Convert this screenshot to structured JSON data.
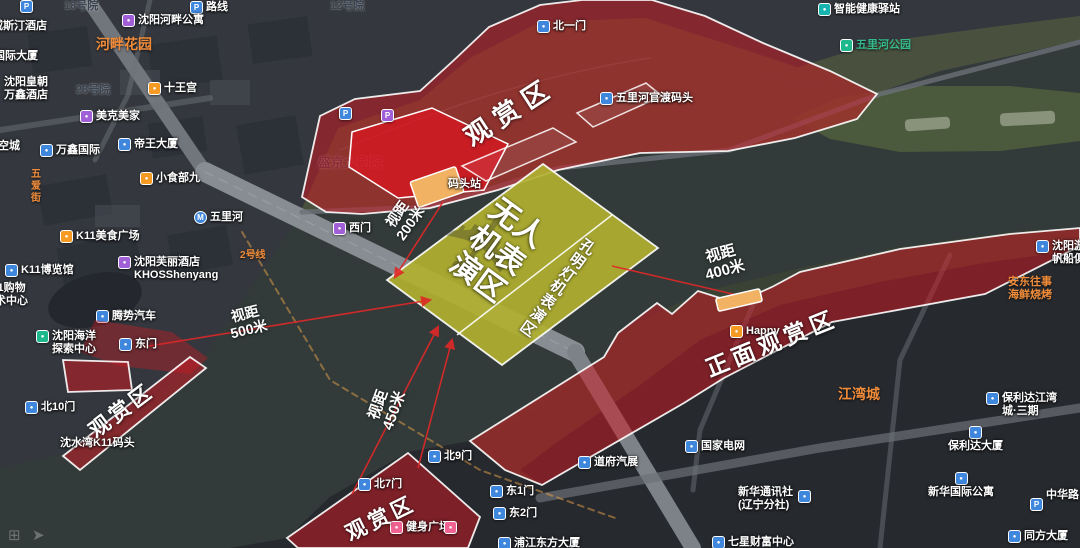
{
  "colors": {
    "viewing_zone_red": "#d01923",
    "bright_zone_red": "#f00f1e",
    "performance_zone_yellow": "#b0b030",
    "dock_orange": "#f2b263",
    "sight_line_red": "#e02828",
    "poi_blue": "#3f87dd",
    "poi_purple": "#a05fd6",
    "poi_orange": "#f59a23",
    "poi_green": "#1db98c",
    "poi_teal": "#17b3ae",
    "poi_pink": "#f06292",
    "area_label_orange": "#f07f32"
  },
  "watermark": {
    "icons": [
      "⊞",
      "➤"
    ]
  },
  "map": {
    "pois": [
      {
        "icon": "parking",
        "t": "",
        "x": 20,
        "y": 0
      },
      {
        "t": "18号院",
        "color": "dark",
        "x": 64,
        "y": 0
      },
      {
        "icon": "parking",
        "t": "路线",
        "x": 190,
        "y": 1
      },
      {
        "t": "12号院",
        "color": "dark",
        "x": 330,
        "y": 0
      },
      {
        "icon": "purple",
        "t": "沈阳河畔公寓",
        "x": 122,
        "y": 14
      },
      {
        "t": "河畔花园",
        "color": "orange",
        "size": 14,
        "x": 96,
        "y": 36
      },
      {
        "t": "威斯汀酒店",
        "x": -8,
        "y": 20
      },
      {
        "t": "国际大厦",
        "x": -6,
        "y": 50
      },
      {
        "lines": [
          "沈阳皇朝",
          "万鑫酒店"
        ],
        "x": 4,
        "y": 76
      },
      {
        "t": "23号院",
        "color": "dark",
        "x": 76,
        "y": 84
      },
      {
        "icon": "orange",
        "t": "十王宫",
        "x": 148,
        "y": 82
      },
      {
        "icon": "purple",
        "t": "美克美家",
        "x": 80,
        "y": 110
      },
      {
        "icon": "blue",
        "t": "万鑫国际",
        "x": 40,
        "y": 144
      },
      {
        "icon": "blue",
        "t": "帝王大厦",
        "x": 118,
        "y": 138
      },
      {
        "t": "空城",
        "x": -2,
        "y": 140
      },
      {
        "icon": "orange",
        "t": "小食部九",
        "x": 140,
        "y": 172
      },
      {
        "t": "五爱街",
        "color": "orange",
        "vertical": true,
        "size": 10,
        "x": 28,
        "y": 168
      },
      {
        "icon": "metro",
        "t": "五里河",
        "x": 194,
        "y": 211
      },
      {
        "t": "2号线",
        "color": "orange",
        "size": 10,
        "x": 240,
        "y": 250
      },
      {
        "icon": "orange",
        "t": "K11美食广场",
        "x": 60,
        "y": 230
      },
      {
        "icon": "purple",
        "lines": [
          "沈阳芙丽酒店",
          "KHOSShenyang"
        ],
        "x": 118,
        "y": 256
      },
      {
        "icon": "blue",
        "t": "K11博览馆",
        "x": 5,
        "y": 264
      },
      {
        "lines": [
          "K11购物",
          "艺术中心"
        ],
        "x": -16,
        "y": 282
      },
      {
        "icon": "blue",
        "t": "腾势汽车",
        "x": 96,
        "y": 310,
        "under": true
      },
      {
        "icon": "green",
        "lines": [
          "沈阳海洋",
          "探索中心"
        ],
        "x": 36,
        "y": 330
      },
      {
        "icon": "blue",
        "t": "东门",
        "x": 119,
        "y": 338
      },
      {
        "icon": "blue",
        "t": "北10门",
        "x": 25,
        "y": 401
      },
      {
        "t": "沈水湾K11码头",
        "x": 60,
        "y": 437
      },
      {
        "icon": "parking",
        "t": "",
        "x": 339,
        "y": 107
      },
      {
        "icon": "parking-purple",
        "t": "",
        "x": 381,
        "y": 109
      },
      {
        "t": "盛京大剧院",
        "color": "dark",
        "size": 13,
        "x": 318,
        "y": 156,
        "under": true
      },
      {
        "icon": "purple",
        "t": "西门",
        "x": 333,
        "y": 222
      },
      {
        "icon": "blue",
        "t": "北一门",
        "x": 537,
        "y": 20
      },
      {
        "icon": "blue",
        "t": "五里河官渡码头",
        "x": 600,
        "y": 92
      },
      {
        "t": "码头站",
        "x": 448,
        "y": 178
      },
      {
        "icon": "teal",
        "t": "智能健康驿站",
        "x": 818,
        "y": 3
      },
      {
        "icon": "green",
        "t": "五里河公园",
        "color": "teal",
        "x": 840,
        "y": 39
      },
      {
        "icon": "blue",
        "lines": [
          "沈阳游艇",
          "帆船俱乐部"
        ],
        "x": 1036,
        "y": 240
      },
      {
        "lines": [
          "安东往事",
          "海鲜烧烤"
        ],
        "color": "orange",
        "x": 1008,
        "y": 276
      },
      {
        "icon": "orange",
        "t": "Happy",
        "x": 730,
        "y": 325
      },
      {
        "t": "江湾城",
        "color": "orange",
        "size": 14,
        "x": 838,
        "y": 386
      },
      {
        "icon": "blue",
        "lines": [
          "保利达江湾",
          "城·三期"
        ],
        "x": 986,
        "y": 392
      },
      {
        "icon": "blue",
        "t": "保利达大厦",
        "stack": true,
        "x": 948,
        "y": 426
      },
      {
        "icon": "blue",
        "t": "新华国际公寓",
        "stack": true,
        "x": 928,
        "y": 472
      },
      {
        "t": "中华路",
        "x": 1046,
        "y": 489
      },
      {
        "icon": "parking",
        "t": "",
        "x": 1030,
        "y": 498
      },
      {
        "icon": "blue",
        "t": "同方大厦",
        "x": 1008,
        "y": 530
      },
      {
        "icon": "blue",
        "t": "国家电网",
        "x": 685,
        "y": 440
      },
      {
        "icon": "blue",
        "t": "道府汽展",
        "x": 578,
        "y": 456
      },
      {
        "lines": [
          "新华通讯社",
          "(辽宁分社)"
        ],
        "x": 738,
        "y": 486
      },
      {
        "icon": "blue",
        "t": "",
        "x": 798,
        "y": 490
      },
      {
        "icon": "blue",
        "t": "七星财富中心",
        "x": 712,
        "y": 536
      },
      {
        "icon": "blue",
        "t": "浦江东方大厦",
        "x": 498,
        "y": 537
      },
      {
        "icon": "pink",
        "t": "健身广场",
        "x": 390,
        "y": 521
      },
      {
        "icon": "pink",
        "t": "",
        "x": 444,
        "y": 521
      },
      {
        "icon": "blue",
        "t": "北9门",
        "x": 428,
        "y": 450
      },
      {
        "icon": "blue",
        "t": "东1门",
        "x": 490,
        "y": 485
      },
      {
        "icon": "blue",
        "t": "东2门",
        "x": 493,
        "y": 507
      },
      {
        "icon": "blue",
        "t": "北7门",
        "x": 358,
        "y": 478
      }
    ]
  },
  "overlay": {
    "zones": [
      {
        "name": "north-bank-viewing-area",
        "style": "band",
        "points": "302,197 320,116 355,99 420,91 453,61 489,27 540,5 582,0 652,0 705,16 763,43 830,71 877,94 857,119 795,138 728,151 640,153 558,170 498,190 430,208 362,214 326,212"
      },
      {
        "name": "theater-plaza-zone",
        "style": "bright",
        "points": "352,132 432,108 508,144 484,190 398,198 349,167"
      },
      {
        "name": "shore-strip-1",
        "style": "outline",
        "points": "462,166 553,128 576,142 486,181"
      },
      {
        "name": "shore-strip-2",
        "style": "outline",
        "points": "577,113 646,83 662,96 593,127"
      },
      {
        "name": "west-shore-blob",
        "style": "soft",
        "points": "95,320 172,332 208,358 190,374 120,366 80,352"
      },
      {
        "name": "west-shore-quad",
        "style": "band",
        "points": "63,360 128,362 132,390 68,392"
      },
      {
        "name": "west-riverside-viewing-strip",
        "style": "band",
        "points": "190,357 206,368 80,470 63,456"
      },
      {
        "name": "south-bank-viewing-area",
        "style": "band",
        "points": "408,453 480,517 468,548 298,548 287,538"
      },
      {
        "name": "front-viewing-area",
        "style": "band",
        "points": "470,441 604,357 618,333 657,303 672,314 698,291 736,303 772,287 800,272 900,249 1010,234 1080,228 1080,246 985,294 832,322 724,378 684,403 542,485 505,470"
      }
    ],
    "performance_zone": {
      "points": "543,164 658,248 502,365 387,280",
      "divider": {
        "x1": 612,
        "y1": 215,
        "x2": 457,
        "y2": 335
      },
      "watermark_icon": "✈"
    },
    "docks": [
      {
        "cx": 437,
        "cy": 187,
        "w": 48,
        "h": 27,
        "rot": -19
      },
      {
        "cx": 739,
        "cy": 300,
        "w": 45,
        "h": 13,
        "rot": -13
      }
    ],
    "sight_lines": [
      {
        "x1": 143,
        "y1": 347,
        "x2": 430,
        "y2": 300,
        "arrow": true
      },
      {
        "x1": 443,
        "y1": 202,
        "x2": 395,
        "y2": 277,
        "arrow": true
      },
      {
        "x1": 352,
        "y1": 494,
        "x2": 438,
        "y2": 327,
        "arrow": true
      },
      {
        "x1": 612,
        "y1": 266,
        "x2": 737,
        "y2": 295,
        "arrow": false
      },
      {
        "x1": 418,
        "y1": 468,
        "x2": 452,
        "y2": 340,
        "arrow": true
      }
    ],
    "annotations": [
      {
        "name": "north-viewing-label",
        "text": "观赏区",
        "x": 510,
        "y": 112,
        "rot": -33,
        "size": 26,
        "ls": 8
      },
      {
        "name": "west-viewing-label",
        "text": "观赏区",
        "x": 122,
        "y": 411,
        "rot": -37,
        "size": 21,
        "ls": 4
      },
      {
        "name": "south-viewing-label",
        "text": "观赏区",
        "x": 381,
        "y": 519,
        "rot": -26,
        "size": 21,
        "ls": 4
      },
      {
        "name": "front-viewing-label",
        "text": "正面观赏区",
        "x": 772,
        "y": 344,
        "rot": -22,
        "size": 23,
        "ls": 5
      },
      {
        "name": "drone-performance-zone-label",
        "lines": [
          "无人",
          "机表",
          "演区"
        ],
        "x": 497,
        "y": 251,
        "rot": 36,
        "size": 30
      },
      {
        "name": "lantern-performance-zone-label",
        "chars": "孔明灯机表演区",
        "x": 557,
        "y": 289,
        "rot": 36,
        "size": 15
      },
      {
        "name": "distance-500m",
        "lines": [
          "视距",
          "500米"
        ],
        "x": 247,
        "y": 322,
        "rot": -14,
        "size": 14
      },
      {
        "name": "distance-200m",
        "lines": [
          "视距",
          "200米"
        ],
        "x": 404,
        "y": 219,
        "rot": -55,
        "size": 14
      },
      {
        "name": "distance-450m",
        "lines": [
          "视距",
          "450米"
        ],
        "x": 387,
        "y": 408,
        "rot": -70,
        "size": 15
      },
      {
        "name": "distance-400m",
        "lines": [
          "视距",
          "400米"
        ],
        "x": 723,
        "y": 263,
        "rot": -15,
        "size": 15
      }
    ]
  }
}
